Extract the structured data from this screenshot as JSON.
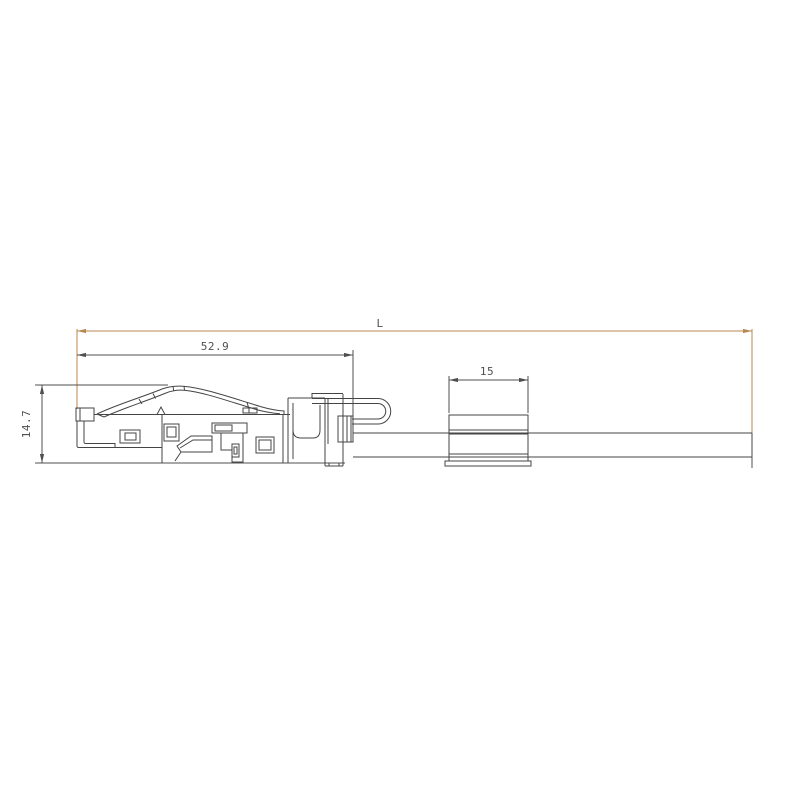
{
  "dimensions": {
    "overall_length": {
      "label": "L"
    },
    "plug_length": {
      "label": "52.9"
    },
    "sleeve_length": {
      "label": "15"
    },
    "plug_height": {
      "label": "14.7"
    }
  },
  "colors": {
    "background": "#ffffff",
    "drawing_line": "#454545",
    "dimension_line": "#4f4f4f",
    "dimension_text": "#4f4f4f",
    "dimension_accent": "#b8874f"
  }
}
